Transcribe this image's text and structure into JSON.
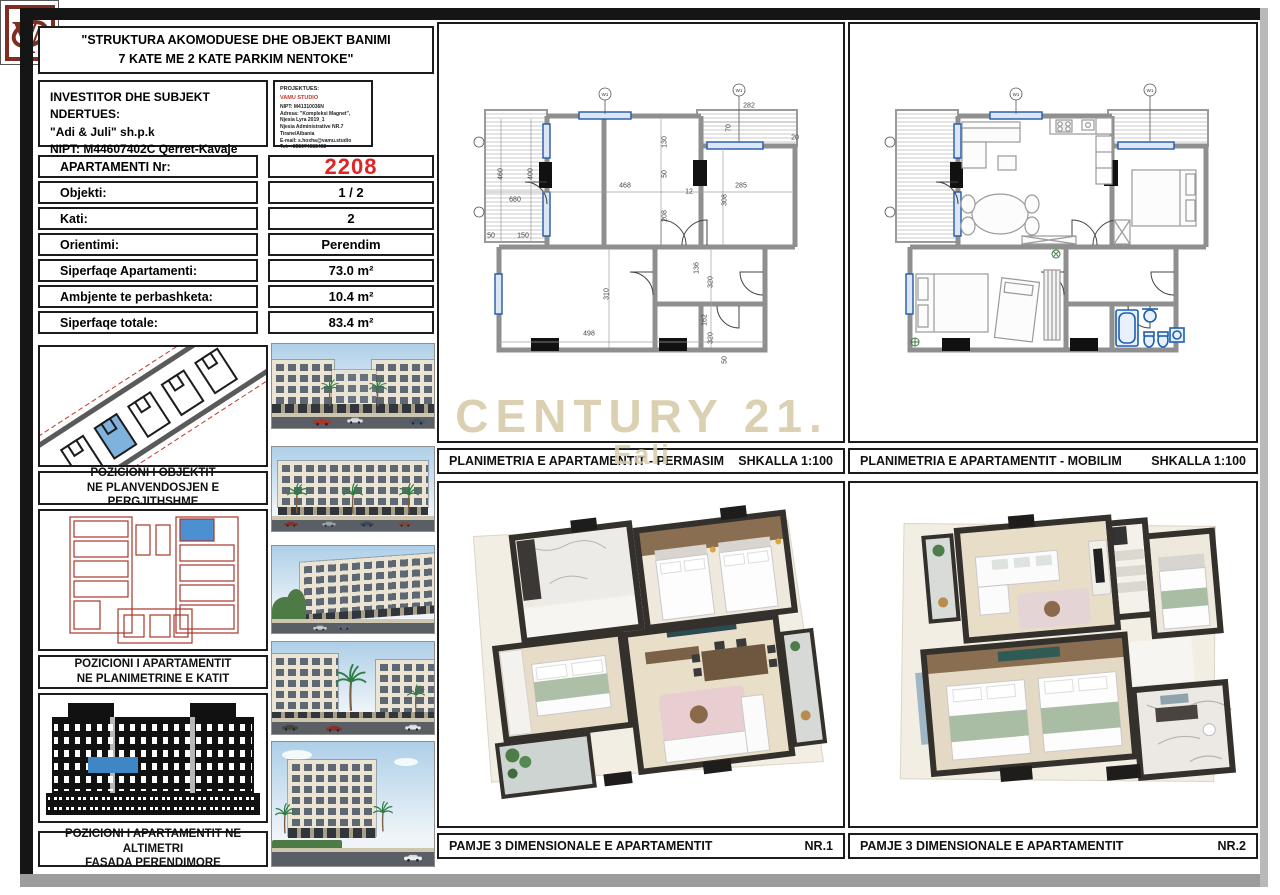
{
  "sheet": {
    "title": {
      "line1": "\"STRUKTURA AKOMODUESE DHE OBJEKT BANIMI",
      "line2": "7 KATE ME 2 KATE PARKIM NENTOKE\""
    },
    "investor": {
      "heading": "INVESTITOR DHE SUBJEKT NDERTUES:",
      "company": "\"Adi & Juli\" sh.p.k",
      "nipt": "NIPT: M44607402C Qerret-Kavaje",
      "tel": "Tel: +355 67 206 5576"
    },
    "designer": {
      "heading": "PROJEKTUES:",
      "studio": "VAMU STUDIO",
      "lines": [
        "NIPT: M41310036N",
        "Adresa: \"Kompleksi Magnet\",",
        "Njesia Lyra 2019_1",
        "Njesia Administrative NR.7",
        "Tirane/Albania",
        "E-mail: s.hoxha@vamu.studio",
        "Tel: +355674088492"
      ]
    },
    "logo_letters": "VA"
  },
  "info_table": {
    "rows": [
      {
        "label": "APARTAMENTI Nr:",
        "value": "2208",
        "highlight": true
      },
      {
        "label": "Objekti:",
        "value": "1 / 2"
      },
      {
        "label": "Kati:",
        "value": "2"
      },
      {
        "label": "Orientimi:",
        "value": "Perendim"
      },
      {
        "label": "Siperfaqe Apartamenti:",
        "value": "73.0 m²"
      },
      {
        "label": "Ambjente te perbashketa:",
        "value": "10.4 m²"
      },
      {
        "label": "Siperfaqe totale:",
        "value": "83.4 m²"
      }
    ]
  },
  "captions": {
    "site": [
      "POZICIONI I OBJEKTIT",
      "NE PLANVENDOSJEN E PERGJITHSHME"
    ],
    "floor": [
      "POZICIONI I APARTAMENTIT",
      "NE PLANIMETRINE E KATIT"
    ],
    "facade": [
      "POZICIONI I APARTAMENTIT NE ALTIMETRI",
      "FASADA PERENDIMORE"
    ]
  },
  "panels": {
    "permasim": {
      "title": "PLANIMETRIA E APARTAMENTIT - PERMASIM",
      "right": "SHKALLA 1:100"
    },
    "mobilim": {
      "title": "PLANIMETRIA E APARTAMENTIT - MOBILIM",
      "right": "SHKALLA 1:100"
    },
    "view1": {
      "title": "PAMJE 3 DIMENSIONALE E APARTAMENTIT",
      "right": "NR.1"
    },
    "view2": {
      "title": "PAMJE 3 DIMENSIONALE E APARTAMENTIT",
      "right": "NR.2"
    }
  },
  "watermark": {
    "line1": "CENTURY 21.",
    "line2": "Eali"
  },
  "plans": {
    "window_tag": "W1",
    "permasim_dimensions": [
      {
        "t": "460",
        "x": 62,
        "y": 150,
        "r": 1
      },
      {
        "t": "400",
        "x": 92,
        "y": 150,
        "r": 1
      },
      {
        "t": "680",
        "x": 76,
        "y": 176
      },
      {
        "t": "50",
        "x": 52,
        "y": 212
      },
      {
        "t": "150",
        "x": 84,
        "y": 212
      },
      {
        "t": "468",
        "x": 186,
        "y": 162
      },
      {
        "t": "285",
        "x": 302,
        "y": 162
      },
      {
        "t": "282",
        "x": 310,
        "y": 82
      },
      {
        "t": "70",
        "x": 290,
        "y": 104,
        "r": 1
      },
      {
        "t": "130",
        "x": 226,
        "y": 118,
        "r": 1
      },
      {
        "t": "50",
        "x": 226,
        "y": 150,
        "r": 1
      },
      {
        "t": "208",
        "x": 226,
        "y": 192,
        "r": 1
      },
      {
        "t": "12",
        "x": 250,
        "y": 168
      },
      {
        "t": "308",
        "x": 286,
        "y": 176,
        "r": 1
      },
      {
        "t": "498",
        "x": 150,
        "y": 310
      },
      {
        "t": "310",
        "x": 168,
        "y": 270,
        "r": 1
      },
      {
        "t": "136",
        "x": 258,
        "y": 244,
        "r": 1
      },
      {
        "t": "320",
        "x": 272,
        "y": 258,
        "r": 1
      },
      {
        "t": "162",
        "x": 266,
        "y": 296,
        "r": 1
      },
      {
        "t": "320",
        "x": 272,
        "y": 314,
        "r": 1
      },
      {
        "t": "50",
        "x": 286,
        "y": 336,
        "r": 1
      },
      {
        "t": "20",
        "x": 356,
        "y": 114
      }
    ],
    "mobilim_dimensions": []
  },
  "photos": [
    "render-street-front",
    "render-facade-long",
    "render-street-perspective",
    "render-entrance-palms",
    "render-corner-view"
  ],
  "colors": {
    "accent_red": "#e02424",
    "studio_red": "#c0392b",
    "highlight_blue": "#5b9bd5",
    "plan_red": "#b03a2e",
    "watermark": "#d8cdab",
    "wall_gray": "#8f8f8f",
    "window_blue": "#2458a6",
    "fixture_blue": "#1d5fae"
  }
}
